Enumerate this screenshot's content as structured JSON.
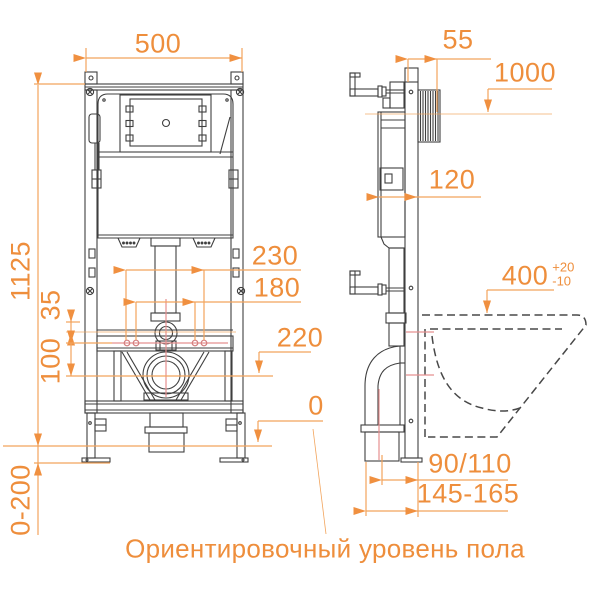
{
  "dimensions": {
    "frame_width": "500",
    "rail_offset": "55",
    "inlet_height_mark": "1000",
    "frame_depth": "120",
    "frame_height": "1125",
    "fixing_span_outer": "230",
    "fixing_span_inner": "180",
    "flush_pipe_offset": "35",
    "drain_offset": "100",
    "drain_center_height": "220",
    "bowl_rim_height": "400",
    "bowl_rim_tol_plus": "+20",
    "bowl_rim_tol_minus": "-10",
    "floor_zero_mark": "0",
    "drain_pipe_diameter": "90/110",
    "drain_outlet_depth": "145-165",
    "leg_adjust_range": "0-200"
  },
  "caption": {
    "floor_level_note": "Ориентировочный уровень пола"
  },
  "colors": {
    "accent_orange": "#EE8E3C",
    "dim_line_orange": "#F2A45C",
    "centerline_pink": "#E59090",
    "drawing_gray": "#3F3F3F",
    "background": "#FFFFFF"
  }
}
